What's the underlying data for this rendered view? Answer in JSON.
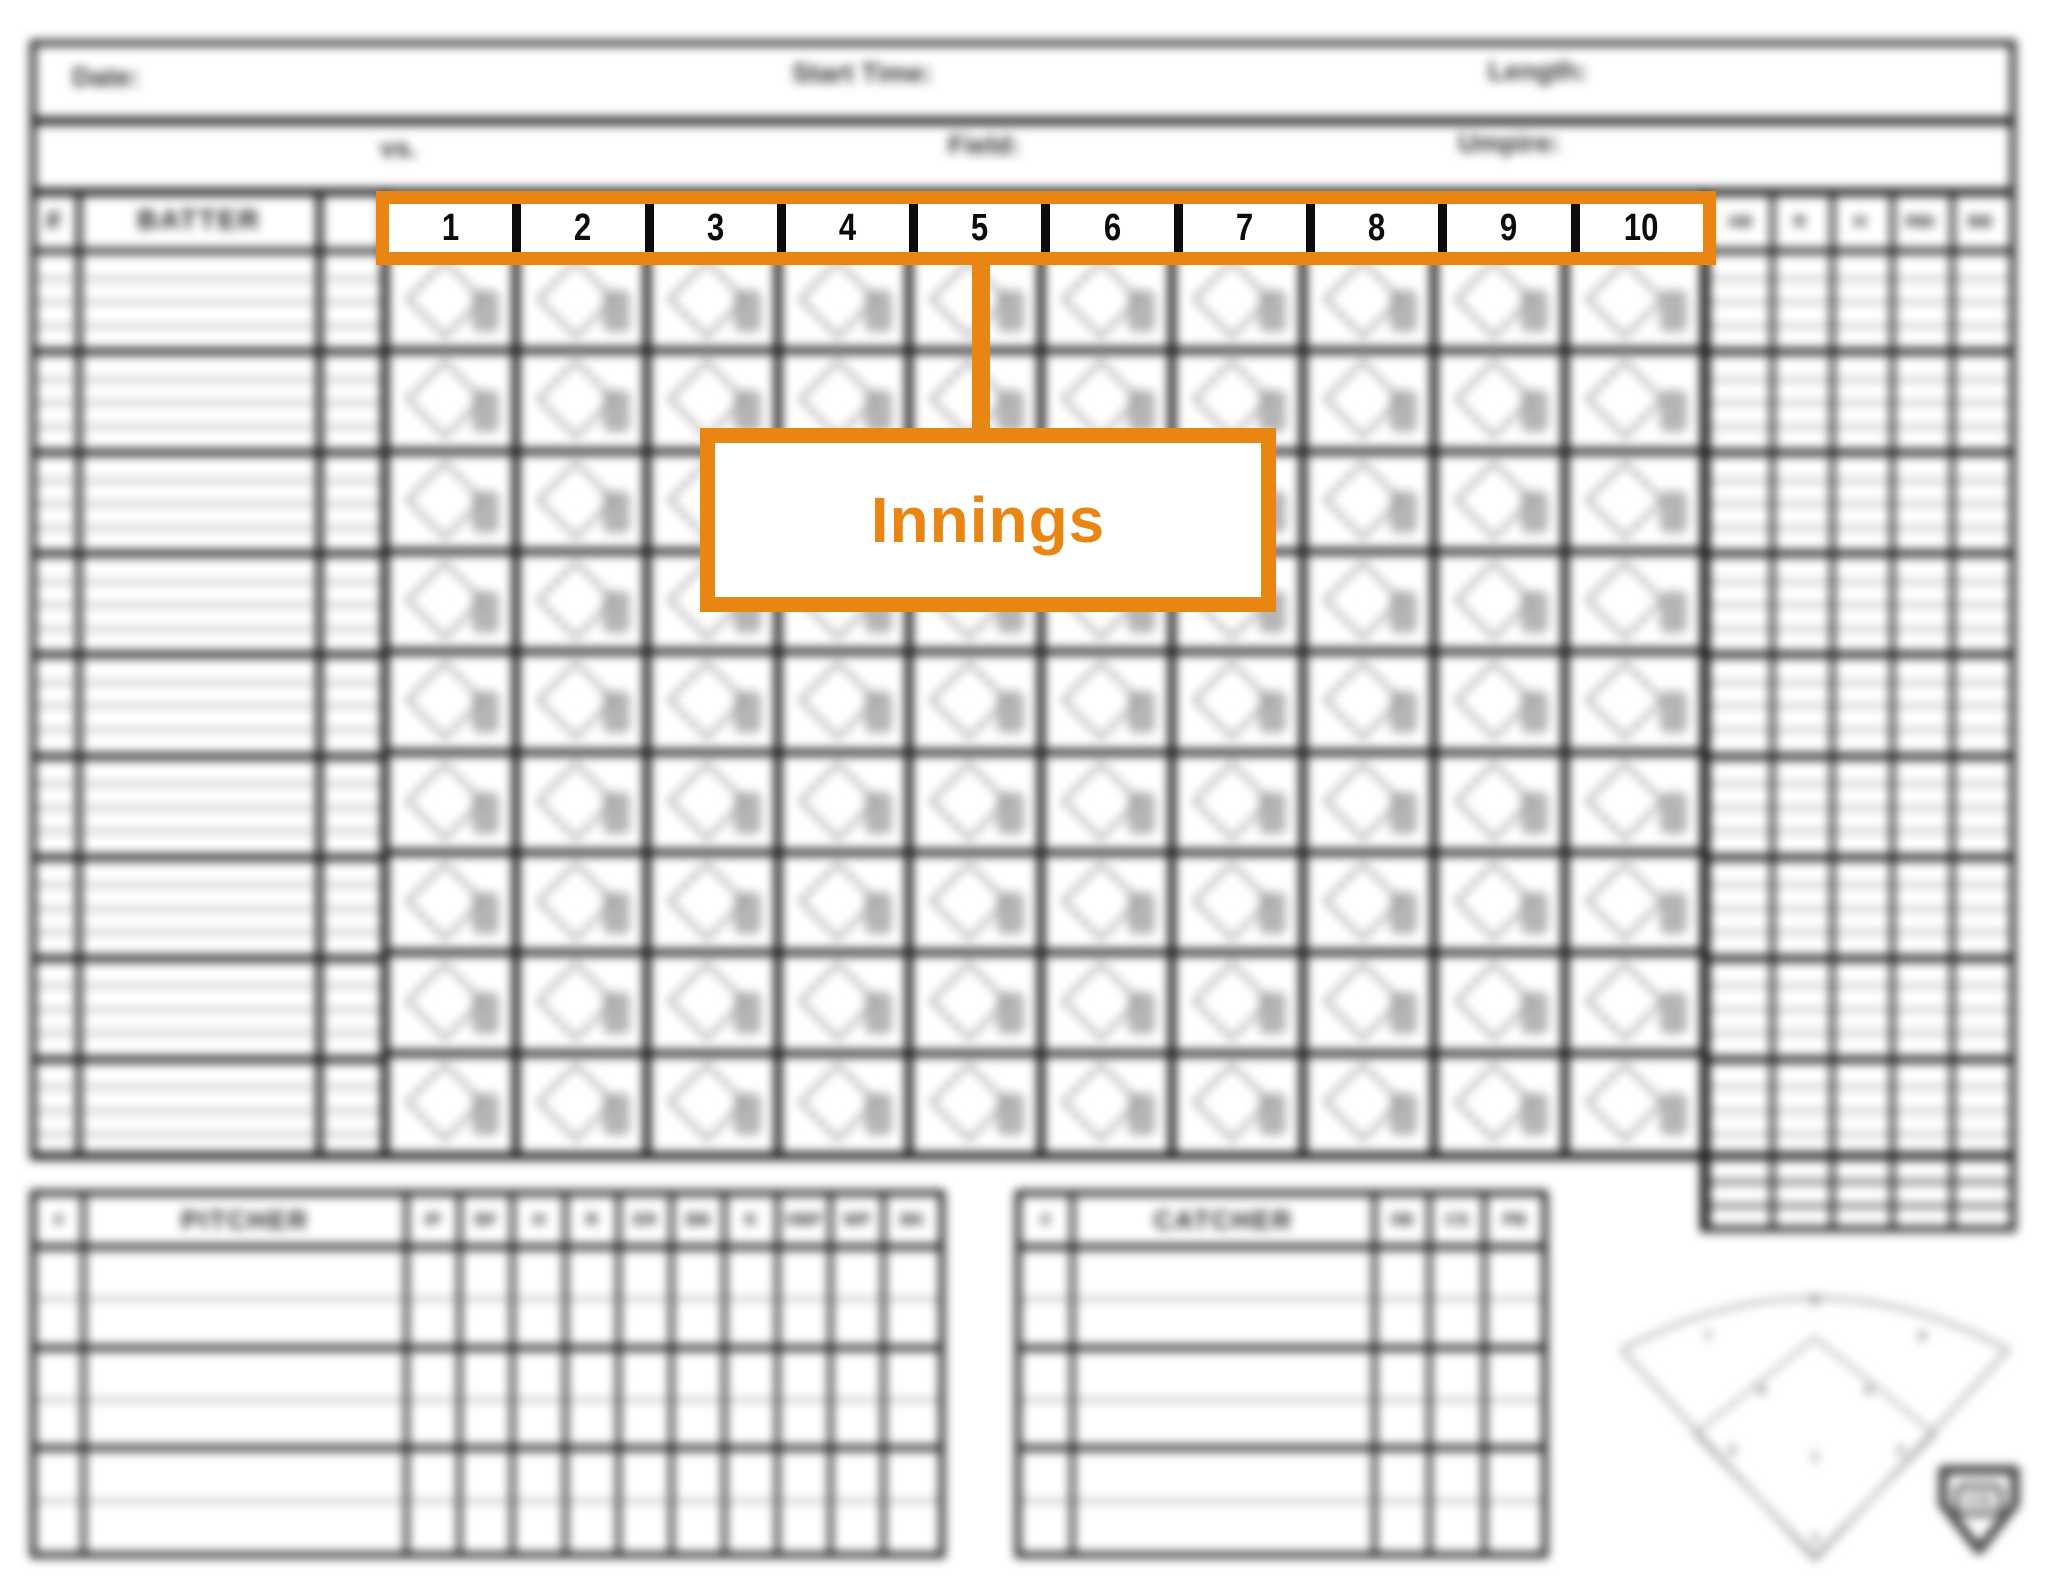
{
  "colors": {
    "accent_orange": "#E98512",
    "grid_dark": "#161616",
    "grid_gray": "#8d8d8d"
  },
  "top_fields": {
    "date": "Date:",
    "start_time": "Start Time:",
    "length": "Length:",
    "vs": "vs.",
    "field": "Field:",
    "umpire": "Umpire:"
  },
  "callout": {
    "label": "Innings"
  },
  "main_table": {
    "number_header": "#",
    "batter_header": "BATTER",
    "innings": [
      "1",
      "2",
      "3",
      "4",
      "5",
      "6",
      "7",
      "8",
      "9",
      "10"
    ],
    "stat_headers": [
      "AB",
      "R",
      "H",
      "RBI",
      "BB"
    ],
    "batter_rows": 9,
    "sub_rows_per_batter": 4
  },
  "pitcher_table": {
    "number_header": "#",
    "name_header": "PITCHER",
    "stat_headers": [
      "IP",
      "BF",
      "H",
      "R",
      "ER",
      "BB",
      "K",
      "HBP",
      "WP",
      "BK"
    ],
    "rows": 6
  },
  "catcher_table": {
    "number_header": "#",
    "name_header": "CATCHER",
    "stat_headers": [
      "SB",
      "CS",
      "PB"
    ],
    "rows": 6
  },
  "field_diagram": {
    "positions": [
      "1",
      "2",
      "3",
      "4",
      "5",
      "6",
      "7",
      "8",
      "9"
    ]
  },
  "logo": {
    "text": "CS"
  }
}
